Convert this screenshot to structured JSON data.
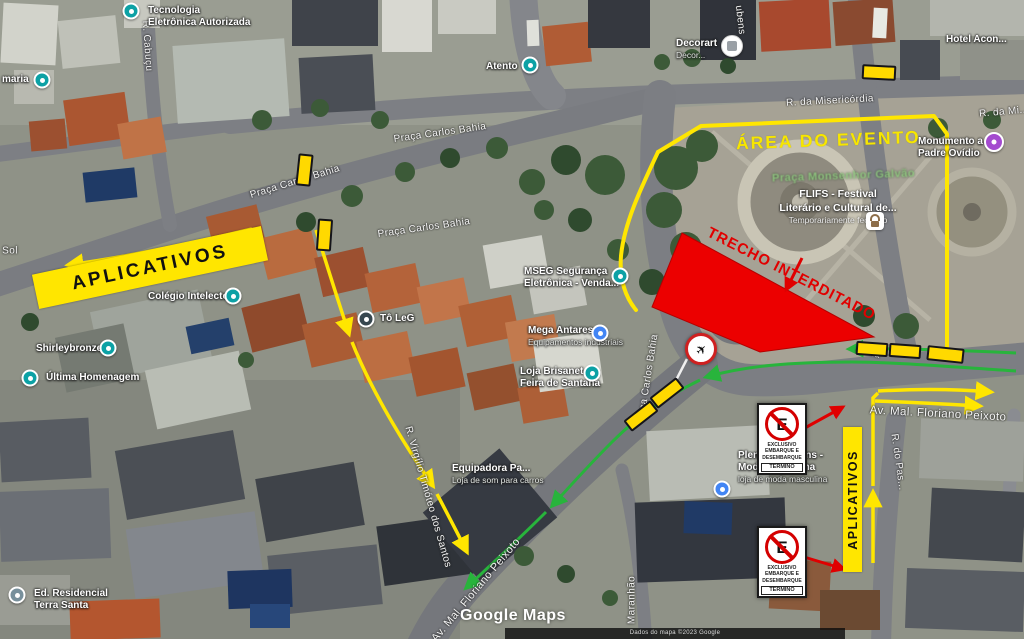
{
  "overlays": {
    "area_label": "ÁREA DO EVENTO",
    "closure_label": "TRECHO INTERDITADO",
    "apps_left": "APLICATIVOS",
    "apps_right": "APLICATIVOS"
  },
  "park": {
    "name": "Praça Monsenhor Galvão"
  },
  "flifs": {
    "line1": "FLIFS - Festival",
    "line2": "Literário e Cultural de...",
    "line3": "Temporariamente fechado"
  },
  "sign": {
    "letter": "E",
    "lines": [
      "EXCLUSIVO",
      "EMBARQUE E",
      "DESEMBARQUE"
    ],
    "footer": "TÉRMINO"
  },
  "watermark": {
    "text": "Google Maps"
  },
  "attribution": {
    "text": "Dados do mapa ©2023 Google"
  },
  "colors": {
    "route_yellow": "#ffe600",
    "route_green": "#28b43c",
    "closure_red": "#ec0000",
    "barrier_yellow": "#ffd900"
  },
  "pois": [
    {
      "id": "tecnologia-eletronica",
      "x": 148,
      "y": 5,
      "lines": [
        {
          "text": "Tecnologia"
        },
        {
          "text": "Eletrônica Autorizada"
        }
      ],
      "pin": {
        "type": "teal",
        "x": 131,
        "y": 11
      }
    },
    {
      "id": "farmacia-partial",
      "x": 2,
      "y": 74,
      "lines": [
        {
          "text": "maria"
        }
      ],
      "pin": {
        "type": "teal",
        "x": 42,
        "y": 80
      }
    },
    {
      "id": "atento",
      "x": 486,
      "y": 61,
      "lines": [
        {
          "text": "Atento"
        }
      ],
      "pin": {
        "type": "teal",
        "x": 530,
        "y": 65
      }
    },
    {
      "id": "decorart",
      "x": 676,
      "y": 38,
      "lines": [
        {
          "text": "Decorart"
        },
        {
          "text": "Decor...",
          "small": true
        }
      ],
      "pin": {
        "type": "photo",
        "x": 732,
        "y": 46
      }
    },
    {
      "id": "hotel-acon",
      "x": 946,
      "y": 34,
      "lines": [
        {
          "text": "Hotel Acon..."
        }
      ]
    },
    {
      "id": "monumento-padre-ovidio",
      "x": 918,
      "y": 136,
      "lines": [
        {
          "text": "Monumento a"
        },
        {
          "text": "Padre Ovídio"
        }
      ],
      "pin": {
        "type": "purple",
        "x": 994,
        "y": 142
      }
    },
    {
      "id": "mseg",
      "x": 524,
      "y": 266,
      "lines": [
        {
          "text": "MSEG Segurança"
        },
        {
          "text": "Eletrônica - Venda..."
        }
      ],
      "pin": {
        "type": "teal",
        "x": 620,
        "y": 276
      }
    },
    {
      "id": "mega-antares",
      "x": 528,
      "y": 325,
      "lines": [
        {
          "text": "Mega Antares"
        },
        {
          "text": "Equipamentos industriais",
          "small": true
        }
      ],
      "pin": {
        "type": "blue",
        "x": 600,
        "y": 333
      }
    },
    {
      "id": "loja-brisanet",
      "x": 520,
      "y": 366,
      "lines": [
        {
          "text": "Loja Brisanet"
        },
        {
          "text": "Feira de Santana"
        }
      ],
      "pin": {
        "type": "teal",
        "x": 592,
        "y": 373
      }
    },
    {
      "id": "colegio-intelecto",
      "x": 148,
      "y": 291,
      "lines": [
        {
          "text": "Colégio Intelecto"
        }
      ],
      "pin": {
        "type": "teal",
        "x": 233,
        "y": 296
      }
    },
    {
      "id": "shirleybronze",
      "x": 36,
      "y": 343,
      "lines": [
        {
          "text": "Shirleybronze"
        }
      ],
      "pin": {
        "type": "teal",
        "x": 108,
        "y": 348
      }
    },
    {
      "id": "ultima-homenagem",
      "x": 46,
      "y": 372,
      "lines": [
        {
          "text": "Última Homenagem"
        }
      ],
      "pin": {
        "type": "teal",
        "x": 30,
        "y": 378
      }
    },
    {
      "id": "to-leg",
      "x": 380,
      "y": 313,
      "lines": [
        {
          "text": "Tô LeG"
        }
      ],
      "pin": {
        "type": "dark",
        "x": 366,
        "y": 319
      }
    },
    {
      "id": "equipadora",
      "x": 452,
      "y": 463,
      "lines": [
        {
          "text": "Equipadora Pa..."
        },
        {
          "text": "Loja de som para carros",
          "small": true
        }
      ]
    },
    {
      "id": "plenytude-jeans",
      "x": 738,
      "y": 450,
      "lines": [
        {
          "text": "Plenytude Jeans -"
        },
        {
          "text": "Moda Masculina"
        },
        {
          "text": "loja de moda masculina",
          "small": true
        }
      ],
      "pin": {
        "type": "blue",
        "x": 722,
        "y": 489
      }
    },
    {
      "id": "ed-residencial-terra-santa",
      "x": 34,
      "y": 588,
      "lines": [
        {
          "text": "Ed. Residencial"
        },
        {
          "text": "Terra Santa"
        }
      ],
      "pin": {
        "type": "gray",
        "x": 17,
        "y": 595
      }
    }
  ],
  "streets": [
    {
      "id": "r-cabucu",
      "text": "R. Cabuçu",
      "x": 147,
      "y": 46,
      "rot": 86
    },
    {
      "id": "praca-carlos-bahia-1",
      "text": "Praça Carlos Bahia",
      "x": 440,
      "y": 133,
      "rot": -8
    },
    {
      "id": "praca-carlos-bahia-2",
      "text": "Praça Carlos Bahia",
      "x": 295,
      "y": 182,
      "rot": -17
    },
    {
      "id": "praca-carlos-bahia-3",
      "text": "Praça Carlos Bahia",
      "x": 424,
      "y": 228,
      "rot": -8
    },
    {
      "id": "r-da-misericordia",
      "text": "R. da Misericórdia",
      "x": 830,
      "y": 101,
      "rot": -3
    },
    {
      "id": "r-da-mi-partial",
      "text": "R. da Mi...",
      "x": 1004,
      "y": 112,
      "rot": -5
    },
    {
      "id": "ca-carlos-bahia",
      "text": "ça Carlos Bahia",
      "x": 649,
      "y": 372,
      "rot": -81
    },
    {
      "id": "bahia-partial",
      "text": "Bahia",
      "x": 868,
      "y": 352,
      "rot": 14,
      "size": 9
    },
    {
      "id": "av-mal-floriano-right",
      "text": "Av. Mal. Floriano Peixoto",
      "x": 938,
      "y": 414,
      "rot": 3,
      "size": 11.5
    },
    {
      "id": "av-mal-floriano-diag",
      "text": "Av. Mal. Floriano Peixoto",
      "x": 476,
      "y": 590,
      "rot": -50,
      "size": 11
    },
    {
      "id": "r-virgilio-timoteo",
      "text": "R. Virgílio Timóteo dos Santos",
      "x": 428,
      "y": 497,
      "rot": 74
    },
    {
      "id": "maranhao",
      "text": "Maranhão",
      "x": 632,
      "y": 600,
      "rot": -90
    },
    {
      "id": "r-do-pas",
      "text": "R. do Pas...",
      "x": 898,
      "y": 462,
      "rot": 82
    },
    {
      "id": "sol",
      "text": "Sol",
      "x": 10,
      "y": 251,
      "rot": 0
    },
    {
      "id": "ubens-partial",
      "text": "ubens",
      "x": 740,
      "y": 20,
      "rot": 83
    }
  ],
  "barriers": [
    {
      "x": 297,
      "y": 154,
      "w": 11,
      "h": 28,
      "rot": 6
    },
    {
      "x": 317,
      "y": 219,
      "w": 11,
      "h": 28,
      "rot": 4
    },
    {
      "x": 862,
      "y": 65,
      "w": 30,
      "h": 11,
      "rot": 3
    },
    {
      "x": 650,
      "y": 386,
      "w": 30,
      "h": 10,
      "rot": -38
    },
    {
      "x": 624,
      "y": 409,
      "w": 30,
      "h": 10,
      "rot": -38
    },
    {
      "x": 856,
      "y": 342,
      "w": 28,
      "h": 10,
      "rot": 4
    },
    {
      "x": 889,
      "y": 344,
      "w": 28,
      "h": 10,
      "rot": 4
    },
    {
      "x": 927,
      "y": 347,
      "w": 33,
      "h": 11,
      "rot": 6
    }
  ]
}
